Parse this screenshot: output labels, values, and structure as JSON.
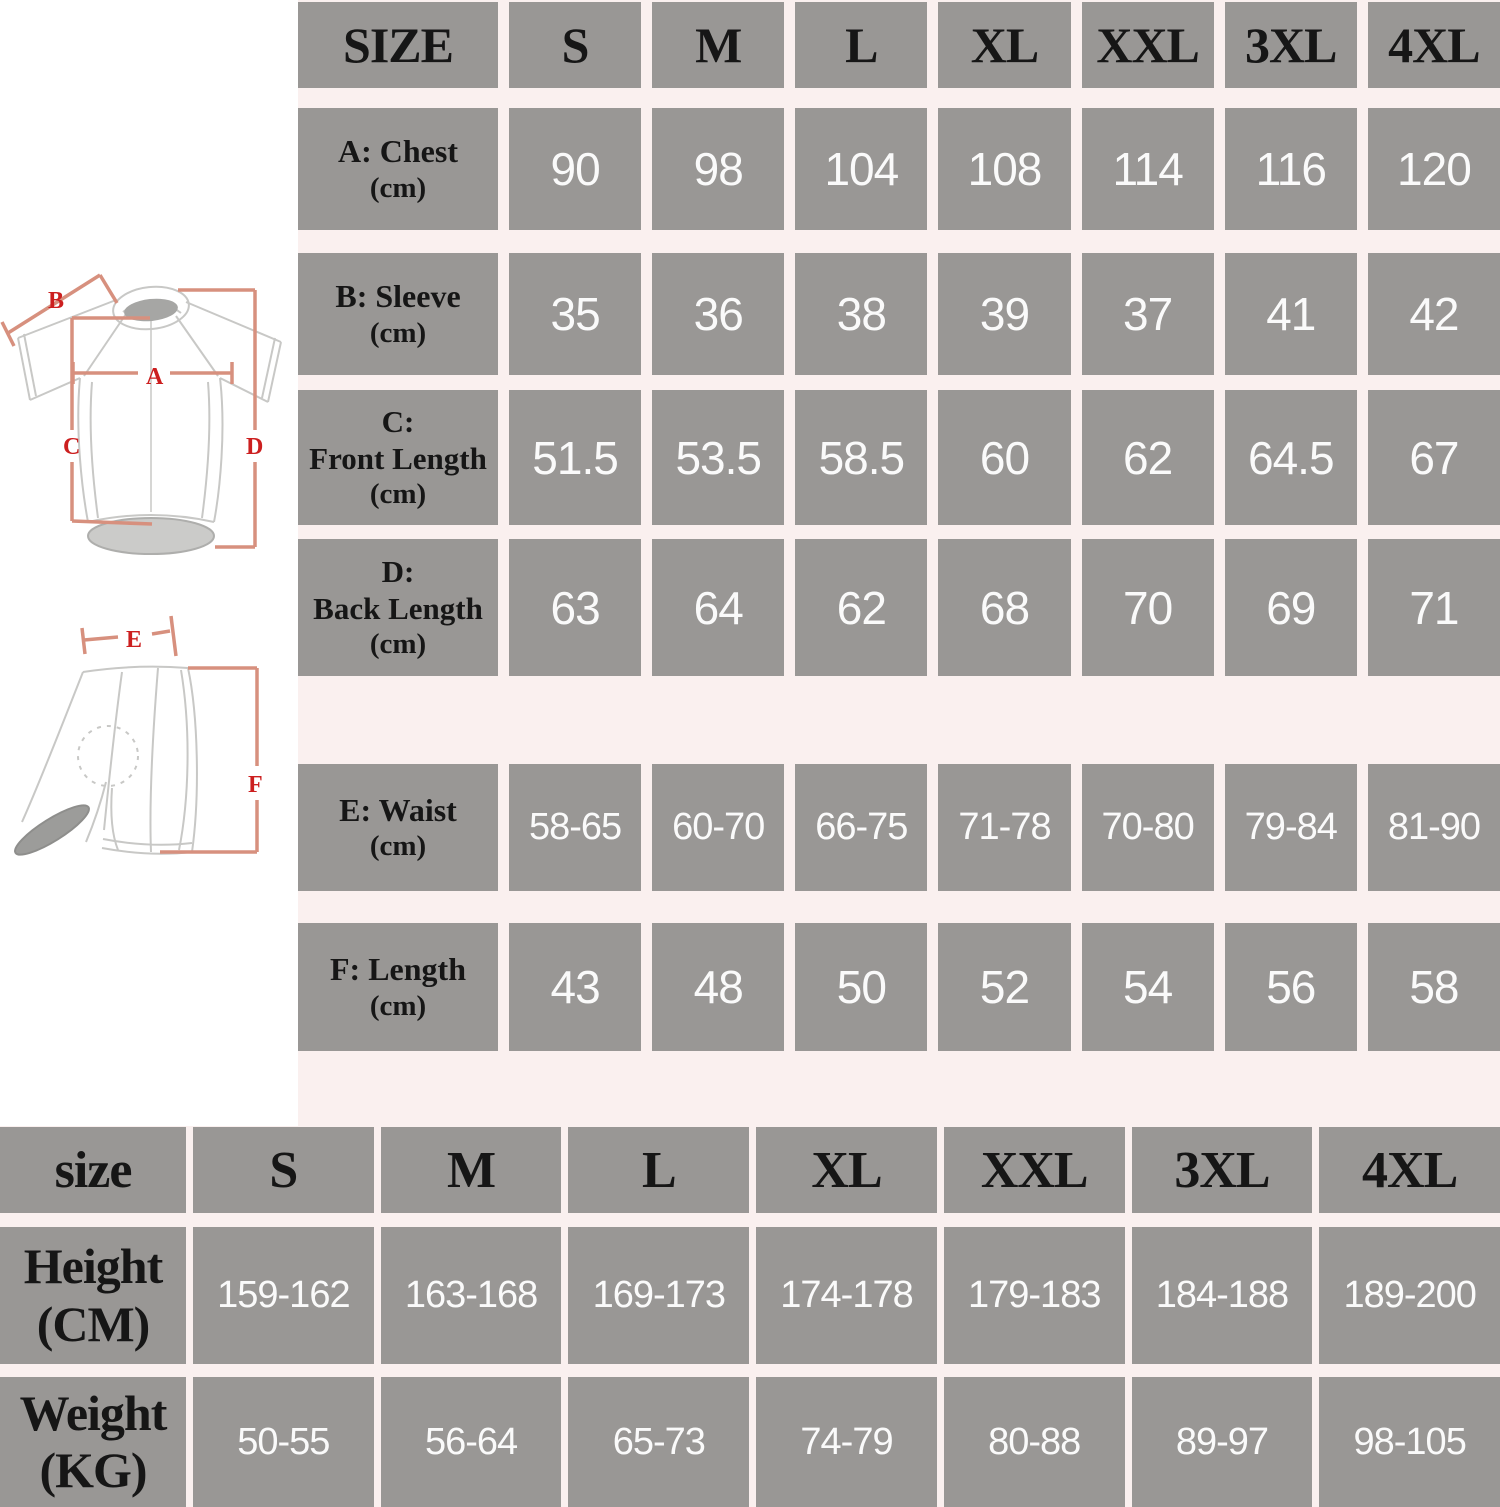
{
  "top_table": {
    "header": [
      "SIZE",
      "S",
      "M",
      "L",
      "XL",
      "XXL",
      "3XL",
      "4XL"
    ],
    "rows": [
      {
        "label": "A: Chest",
        "unit": "(cm)",
        "values": [
          "90",
          "98",
          "104",
          "108",
          "114",
          "116",
          "120"
        ]
      },
      {
        "label": "B: Sleeve",
        "unit": "(cm)",
        "values": [
          "35",
          "36",
          "38",
          "39",
          "37",
          "41",
          "42"
        ]
      },
      {
        "label_top": "C:",
        "label": "Front Length",
        "unit": "(cm)",
        "values": [
          "51.5",
          "53.5",
          "58.5",
          "60",
          "62",
          "64.5",
          "67"
        ]
      },
      {
        "label_top": "D:",
        "label": "Back Length",
        "unit": "(cm)",
        "values": [
          "63",
          "64",
          "62",
          "68",
          "70",
          "69",
          "71"
        ]
      },
      {
        "label": "E: Waist",
        "unit": "(cm)",
        "values": [
          "58-65",
          "60-70",
          "66-75",
          "71-78",
          "70-80",
          "79-84",
          "81-90"
        ]
      },
      {
        "label": "F: Length",
        "unit": "(cm)",
        "values": [
          "43",
          "48",
          "50",
          "52",
          "54",
          "56",
          "58"
        ]
      }
    ]
  },
  "bottom_table": {
    "header": [
      "size",
      "S",
      "M",
      "L",
      "XL",
      "XXL",
      "3XL",
      "4XL"
    ],
    "rows": [
      {
        "label": "Height",
        "unit": "(CM)",
        "values": [
          "159-162",
          "163-168",
          "169-173",
          "174-178",
          "179-183",
          "184-188",
          "189-200"
        ]
      },
      {
        "label": "Weight",
        "unit": "(KG)",
        "values": [
          "50-55",
          "56-64",
          "65-73",
          "74-79",
          "80-88",
          "89-97",
          "98-105"
        ]
      }
    ]
  },
  "diagram": {
    "labels": {
      "A": "A",
      "B": "B",
      "C": "C",
      "D": "D",
      "E": "E",
      "F": "F"
    }
  },
  "colors": {
    "cell_gray": "#999795",
    "background_pink": "#faf0ef",
    "value_text": "#fafafa",
    "label_text": "#161616",
    "measure_label_red": "#cc1f1f",
    "measure_line_salmon": "#d7907e",
    "garment_outline": "#c8c8c6"
  }
}
